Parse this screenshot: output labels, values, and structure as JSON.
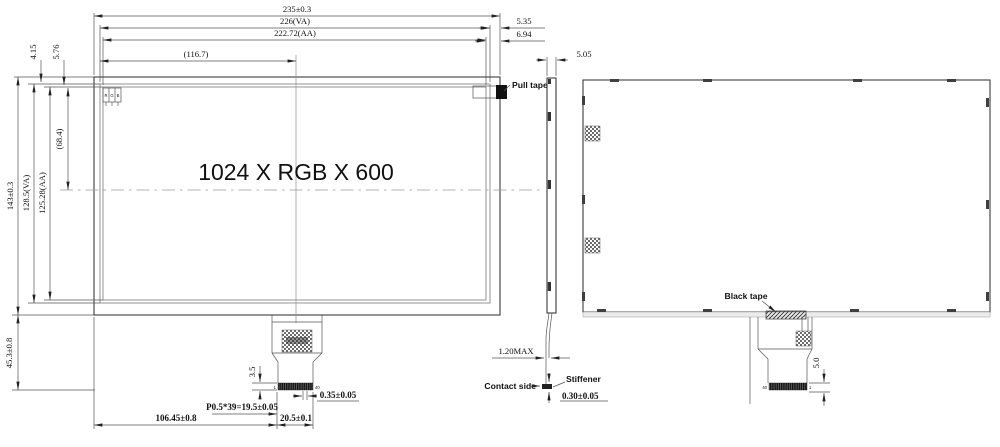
{
  "drawing": {
    "title": "1024 X RGB X 600",
    "front": {
      "dim_total_width": "235±0.3",
      "dim_va_width": "226(VA)",
      "dim_aa_width": "222.72(AA)",
      "dim_half_width": "(116.7)",
      "dim_va_right_gap": "5.35",
      "dim_aa_right_gap": "6.94",
      "dim_va_top_gap": "4.15",
      "dim_aa_top_gap": "5.76",
      "dim_total_height": "143±0.3",
      "dim_va_height": "128.5(VA)",
      "dim_aa_height": "125.28(AA)",
      "dim_half_height": "(68.4)",
      "dim_bottom_height": "45.3±0.8",
      "dim_fpc_offset": "106.45±0.8",
      "dim_pin_pitch": "P0.5*39=19.5±0.05",
      "dim_fpc_width": "20.5±0.1",
      "dim_finger_width": "0.35±0.05",
      "dim_stiffener_height": "3.5",
      "pin_first": "1",
      "pin_last": "40",
      "pull_tape_label": "Pull tape",
      "subpixel_r": "R",
      "subpixel_g": "G",
      "subpixel_b": "B"
    },
    "side": {
      "dim_thickness": "5.05",
      "dim_fpc_thickness": "1.20MAX",
      "contact_side_label": "Contact side",
      "stiffener_label": "Stiffener",
      "dim_stiffener_thickness": "0.30±0.05"
    },
    "back": {
      "black_tape_label": "Black tape",
      "dim_stiffener_height": "5.0",
      "pin_last": "40",
      "pin_first": "1"
    }
  }
}
